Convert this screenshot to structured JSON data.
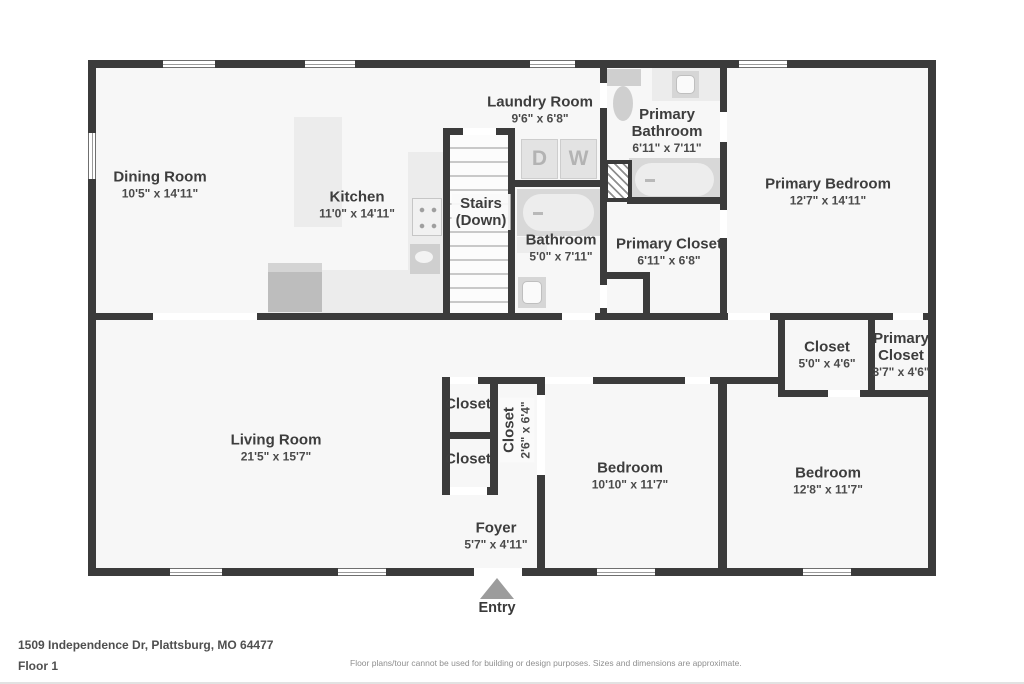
{
  "meta": {
    "address": "1509 Independence Dr, Plattsburg, MO 64477",
    "floor_label": "Floor 1",
    "disclaimer": "Floor plans/tour cannot be used for building or design purposes. Sizes and dimensions are approximate.",
    "entry_label": "Entry"
  },
  "colors": {
    "wall": "#3b3b3b",
    "floor": "#f7f7f7",
    "fixture": "#e0e0e0",
    "entry_arrow": "#9c9c9c"
  },
  "laundry": {
    "dryer_label": "D",
    "washer_label": "W"
  },
  "rooms": [
    {
      "id": "dining-room",
      "name_lines": [
        "Dining Room"
      ],
      "dims": "10'5\" x 14'11\"",
      "cx": 160,
      "cy": 185
    },
    {
      "id": "kitchen",
      "name_lines": [
        "Kitchen"
      ],
      "dims": "11'0\" x 14'11\"",
      "cx": 357,
      "cy": 205
    },
    {
      "id": "laundry-room",
      "name_lines": [
        "Laundry Room"
      ],
      "dims": "9'6\" x 6'8\"",
      "cx": 540,
      "cy": 110
    },
    {
      "id": "primary-bathroom",
      "name_lines": [
        "Primary",
        "Bathroom"
      ],
      "dims": "6'11\" x 7'11\"",
      "cx": 667,
      "cy": 131
    },
    {
      "id": "primary-bedroom",
      "name_lines": [
        "Primary Bedroom"
      ],
      "dims": "12'7\" x 14'11\"",
      "cx": 828,
      "cy": 192
    },
    {
      "id": "stairs",
      "name_lines": [
        "Stairs",
        "(Down)"
      ],
      "dims": "",
      "cx": 481,
      "cy": 212,
      "boxed": true
    },
    {
      "id": "bathroom",
      "name_lines": [
        "Bathroom"
      ],
      "dims": "5'0\" x 7'11\"",
      "cx": 561,
      "cy": 248
    },
    {
      "id": "primary-closet",
      "name_lines": [
        "Primary Closet"
      ],
      "dims": "6'11\" x 6'8\"",
      "cx": 669,
      "cy": 252
    },
    {
      "id": "closet-mid",
      "name_lines": [
        "Closet"
      ],
      "dims": "5'0\" x 4'6\"",
      "cx": 827,
      "cy": 355
    },
    {
      "id": "primary-closet-small",
      "name_lines": [
        "Primary",
        "Closet"
      ],
      "dims": "3'7\" x 4'6\"",
      "cx": 901,
      "cy": 355
    },
    {
      "id": "living-room",
      "name_lines": [
        "Living Room"
      ],
      "dims": "21'5\" x 15'7\"",
      "cx": 276,
      "cy": 448
    },
    {
      "id": "closet-a",
      "name_lines": [
        "Closet"
      ],
      "dims": "",
      "cx": 468,
      "cy": 404
    },
    {
      "id": "closet-b",
      "name_lines": [
        "Closet"
      ],
      "dims": "",
      "cx": 468,
      "cy": 459
    },
    {
      "id": "closet-vertical",
      "name_lines": [
        "Closet"
      ],
      "dims": "2'6\" x 6'4\"",
      "cx": 517,
      "cy": 430,
      "rotate": true,
      "boxed": true
    },
    {
      "id": "bedroom-center",
      "name_lines": [
        "Bedroom"
      ],
      "dims": "10'10\" x 11'7\"",
      "cx": 630,
      "cy": 476
    },
    {
      "id": "bedroom-right",
      "name_lines": [
        "Bedroom"
      ],
      "dims": "12'8\" x 11'7\"",
      "cx": 828,
      "cy": 481
    },
    {
      "id": "foyer",
      "name_lines": [
        "Foyer"
      ],
      "dims": "5'7\" x 4'11\"",
      "cx": 496,
      "cy": 536
    }
  ]
}
